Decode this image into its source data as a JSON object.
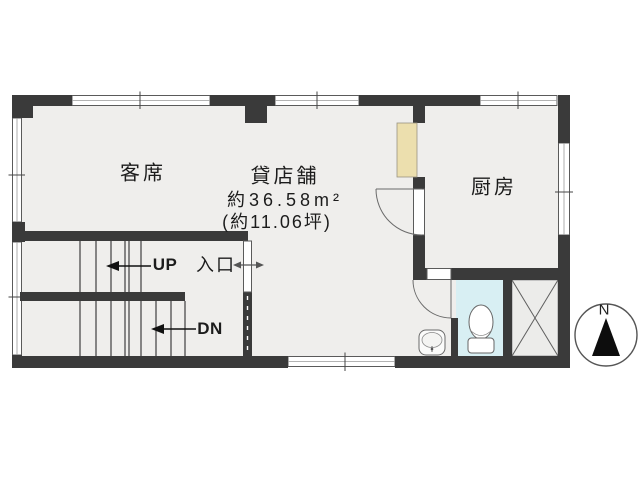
{
  "plan": {
    "type": "floor-plan",
    "rooms": {
      "guest_seating": {
        "label": "客席"
      },
      "rental_shop": {
        "label": "貸店舗",
        "area_sqm": "約36.58m²",
        "area_tsubo": "(約11.06坪)"
      },
      "kitchen": {
        "label": "厨房"
      }
    },
    "stairs": {
      "up": "UP",
      "down": "DN"
    },
    "entrance": {
      "label": "入口"
    },
    "compass": {
      "north": "N"
    },
    "icons": {
      "toilet": "toilet-icon",
      "washbasin": "washbasin-icon",
      "compass_north": "compass-north-icon",
      "shaft_cross": "shaft-cross-icon",
      "door_swings": "door-swing-arc"
    },
    "colors": {
      "wall": "#3a3a3a",
      "floor": "#efeeec",
      "toilet_floor": "#d8eff3",
      "counter": "#ecdfae",
      "shaft_fill": "#ececea",
      "line": "#5a5a5a",
      "text": "#1c1c1c"
    }
  }
}
